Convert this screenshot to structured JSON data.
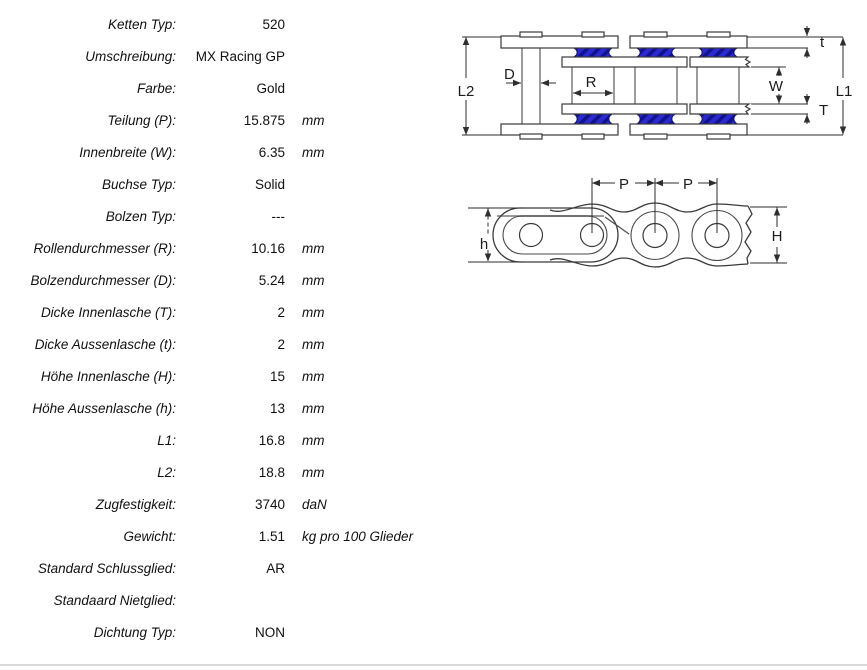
{
  "table": {
    "rows": [
      {
        "label": "Ketten Typ:",
        "value": "520",
        "unit": ""
      },
      {
        "label": "Umschreibung:",
        "value": "MX Racing GP",
        "unit": ""
      },
      {
        "label": "Farbe:",
        "value": "Gold",
        "unit": ""
      },
      {
        "label": "Teilung (P):",
        "value": "15.875",
        "unit": "mm"
      },
      {
        "label": "Innenbreite (W):",
        "value": "6.35",
        "unit": "mm"
      },
      {
        "label": "Buchse Typ:",
        "value": "Solid",
        "unit": ""
      },
      {
        "label": "Bolzen Typ:",
        "value": "---",
        "unit": ""
      },
      {
        "label": "Rollendurchmesser (R):",
        "value": "10.16",
        "unit": "mm"
      },
      {
        "label": "Bolzendurchmesser (D):",
        "value": "5.24",
        "unit": "mm"
      },
      {
        "label": "Dicke Innenlasche (T):",
        "value": "2",
        "unit": "mm"
      },
      {
        "label": "Dicke Aussenlasche (t):",
        "value": "2",
        "unit": "mm"
      },
      {
        "label": "Höhe Innenlasche (H):",
        "value": "15",
        "unit": "mm"
      },
      {
        "label": "Höhe Aussenlasche (h):",
        "value": "13",
        "unit": "mm"
      },
      {
        "label": "L1:",
        "value": "16.8",
        "unit": "mm"
      },
      {
        "label": "L2:",
        "value": "18.8",
        "unit": "mm"
      },
      {
        "label": "Zugfestigkeit:",
        "value": "3740",
        "unit": "daN"
      },
      {
        "label": "Gewicht:",
        "value": "1.51",
        "unit": "kg pro 100 Glieder"
      },
      {
        "label": "Standard Schlussglied:",
        "value": "AR",
        "unit": ""
      },
      {
        "label": "Standaard Nietglied:",
        "value": "",
        "unit": ""
      },
      {
        "label": "Dichtung Typ:",
        "value": "NON",
        "unit": ""
      }
    ]
  },
  "diagram_top": {
    "labels": {
      "l2": "L2",
      "d": "D",
      "r": "R",
      "w": "W",
      "t_small": "t",
      "t_big": "T",
      "l1": "L1"
    }
  },
  "diagram_side": {
    "labels": {
      "p1": "P",
      "p2": "P",
      "h": "h",
      "h_big": "H"
    }
  },
  "colors": {
    "roller_base": "#2a2ace",
    "roller_stripe": "#12128e",
    "divider": "#d9d9d9"
  }
}
